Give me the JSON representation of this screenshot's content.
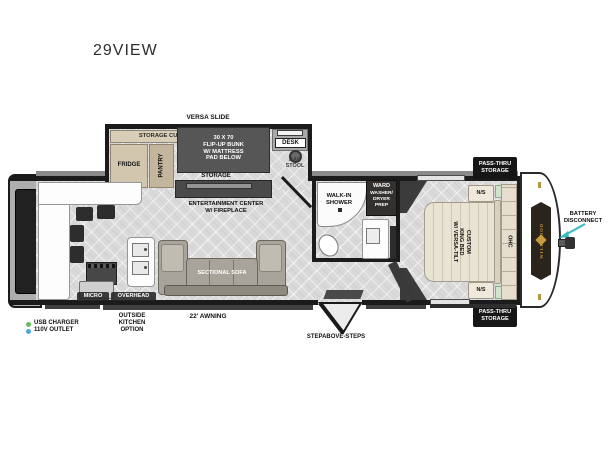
{
  "title": "29VIEW",
  "slide": {
    "versa_slide": "VERSA SLIDE",
    "storage_cubbies": "STORAGE CUBBIES",
    "fridge": "FRIDGE",
    "pantry": "PANTRY",
    "bunk": "30 X 70\nFLIP-UP BUNK\nW/ MATTRESS\nPAD BELOW",
    "storage": "STORAGE",
    "desk": "DESK",
    "bar_stool": "BAR\nSTOOL"
  },
  "living": {
    "entertainment": "ENTERTAINMENT CENTER\nW/ FIREPLACE",
    "sofa": "SECTIONAL SOFA"
  },
  "kitchen": {
    "micro": "MICRO",
    "overhead": "OVERHEAD",
    "outside_kitchen": "OUTSIDE\nKITCHEN\nOPTION"
  },
  "bath": {
    "shower": "WALK-IN\nSHOWER",
    "ward": "WARD",
    "ward_sub": "WASHER/\nDRYER\nPREP"
  },
  "bedroom": {
    "bed": "CUSTOM\nKING BED\nW/ VERSA-TILT",
    "ns_top": "N/S",
    "ns_bottom": "N/S",
    "ohc": "OHC",
    "pass_thru_top": "PASS-THRU\nSTORAGE",
    "pass_thru_bottom": "PASS-THRU\nSTORAGE"
  },
  "exterior": {
    "awning": "22' AWNING",
    "steps": "STEPABOVE-STEPS",
    "battery": "BATTERY\nDISCONNECT",
    "brand": "WILDWOOD"
  },
  "legend": {
    "usb": "USB CHARGER",
    "outlet": "110V OUTLET",
    "usb_color": "#5cbf5a",
    "outlet_color": "#4aa7e0"
  },
  "colors": {
    "wall": "#1b1b1b",
    "floor": "#d9d9d9",
    "cabinet_tan": "#d2c6ae",
    "dark_fixture": "#565656",
    "bed_cream": "#e9e3d4",
    "arrow_teal": "#35b8c6",
    "logo_gold": "#c79b3b"
  }
}
